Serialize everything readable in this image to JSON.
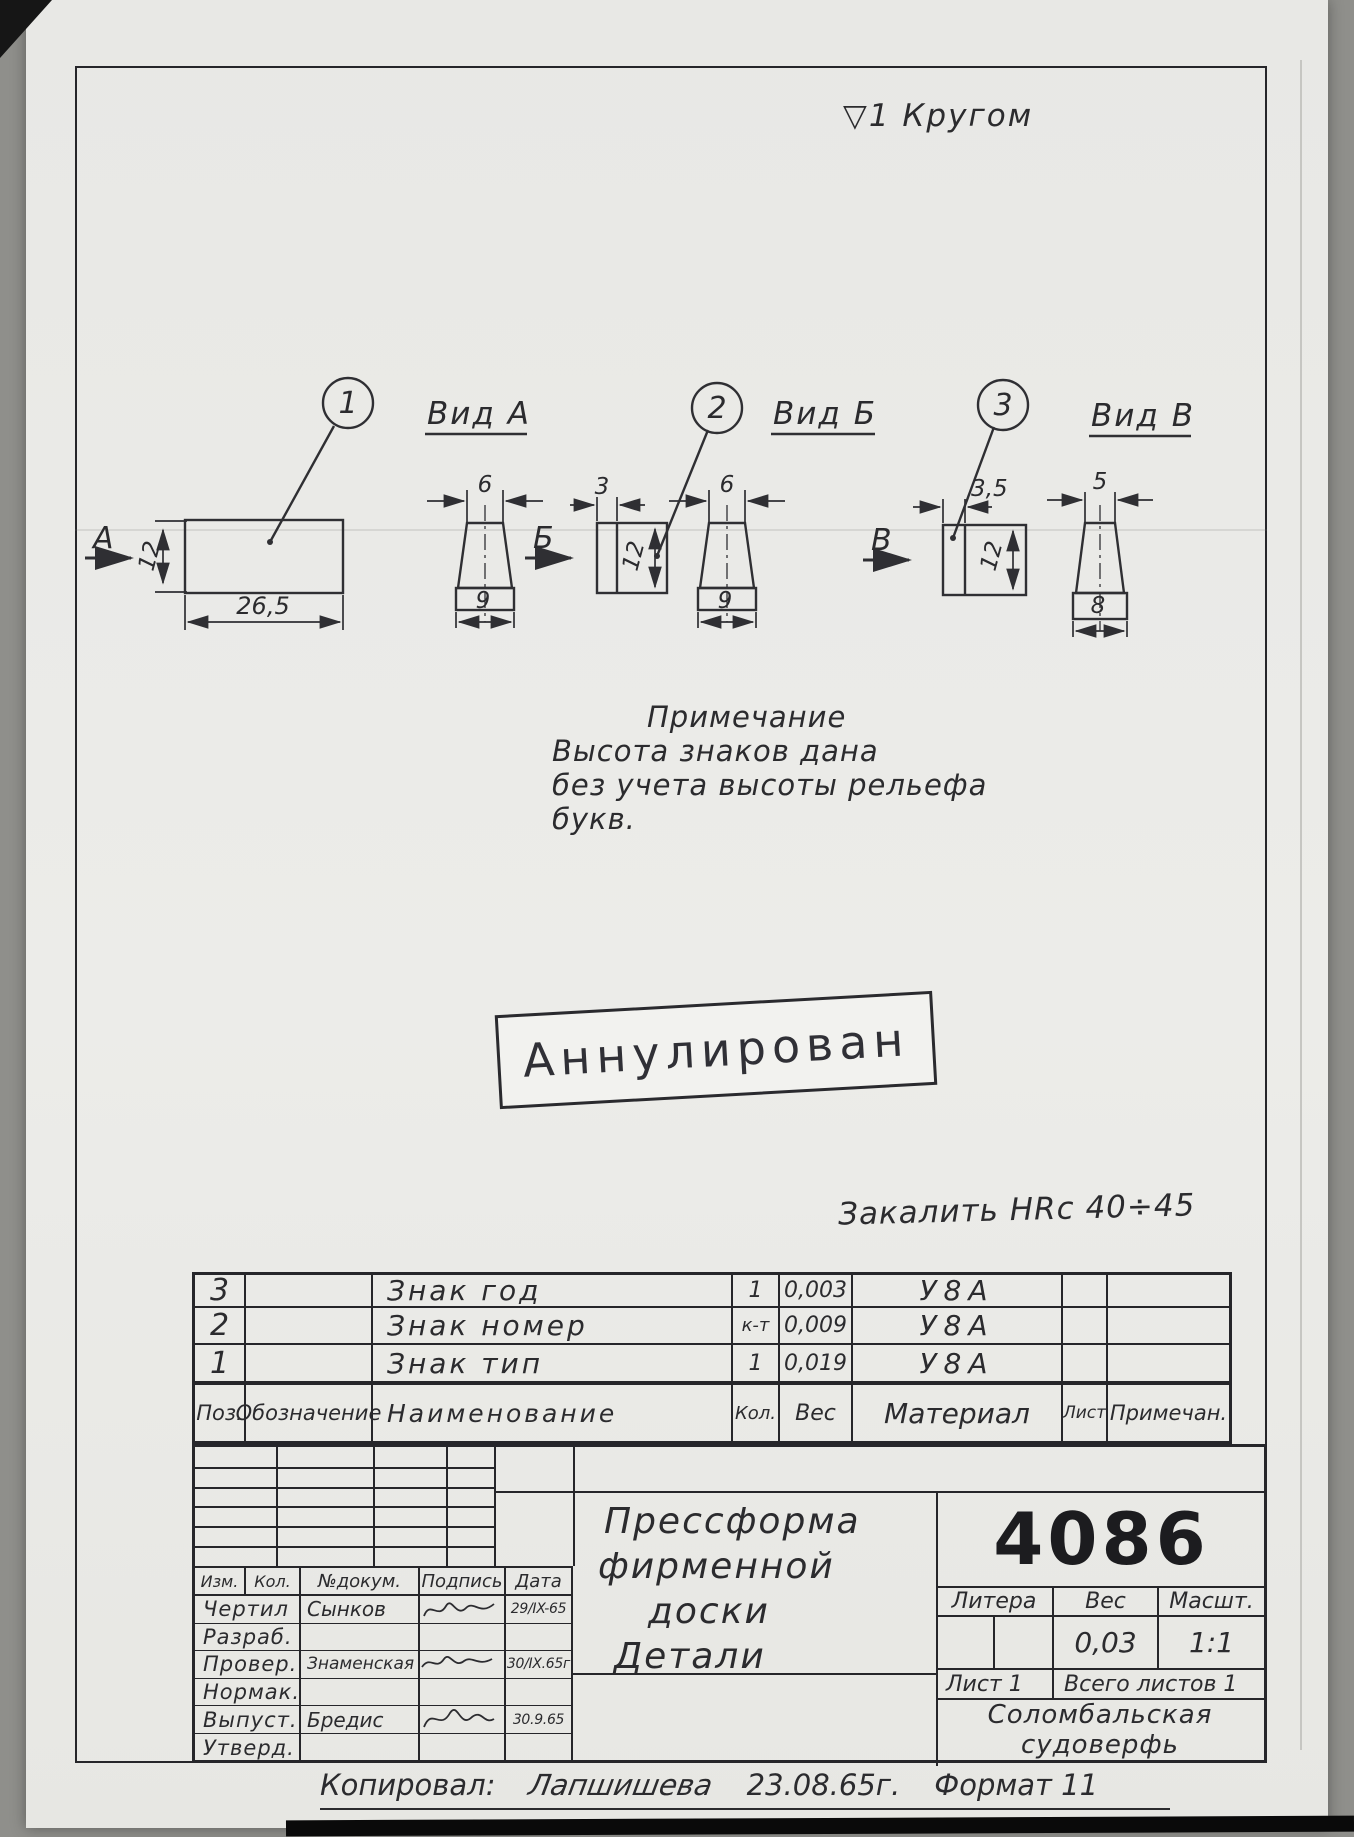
{
  "annotations": {
    "surface_finish": "▽1 Кругом",
    "hardening": "Закалить HRc 40÷45",
    "stamp": "Аннулирован"
  },
  "note": {
    "title": "Примечание",
    "line1": "Высота знаков дана",
    "line2": "без учета высоты рельефа",
    "line3": "букв."
  },
  "views": {
    "callout_1": "1",
    "callout_2": "2",
    "callout_3": "3",
    "label_a": "Вид А",
    "label_b": "Вид Б",
    "label_v": "Вид В",
    "arrow_a": "А",
    "arrow_b": "Б",
    "arrow_v": "В",
    "dim_plate_width": "26,5",
    "dim_plate_height": "12",
    "dim_a_top": "6",
    "dim_a_bottom": "9",
    "dim_b_thickness": "3",
    "dim_b_height": "12",
    "dim_b_top": "6",
    "dim_b_bottom": "9",
    "dim_v_thickness": "3,5",
    "dim_v_height": "12",
    "dim_v_top": "5",
    "dim_v_bottom": "8"
  },
  "parts_table": {
    "headers": {
      "pos": "Поз.",
      "designation": "Обозначение",
      "name": "Наименование",
      "qty": "Кол.",
      "weight": "Вес",
      "material": "Материал",
      "sheet": "Лист",
      "note": "Примечан."
    },
    "rows": [
      {
        "pos": "3",
        "name": "Знак год",
        "qty": "1",
        "weight": "0,003",
        "material": "У8А"
      },
      {
        "pos": "2",
        "name": "Знак номер",
        "qty": "к-т",
        "weight": "0,009",
        "material": "У8А"
      },
      {
        "pos": "1",
        "name": "Знак тип",
        "qty": "1",
        "weight": "0,019",
        "material": "У8А"
      }
    ]
  },
  "title_block": {
    "doc_number": "4086",
    "title_lines": [
      "Прессформа",
      "фирменной",
      "доски",
      "Детали"
    ],
    "litera_label": "Литера",
    "weight_label": "Вес",
    "scale_label": "Масшт.",
    "weight_value": "0,03",
    "scale_value": "1:1",
    "sheet_info": "Лист 1",
    "total_sheets": "Всего листов 1",
    "org_line1": "Соломбальская",
    "org_line2": "судоверфь",
    "rev_headers": {
      "izm": "Изм.",
      "kol": "Кол.",
      "doc": "№докум.",
      "sign": "Подпись",
      "date": "Дата"
    },
    "staff": [
      {
        "role": "Чертил",
        "name": "Сынков",
        "date": "29/IX-65"
      },
      {
        "role": "Разраб.",
        "name": "",
        "date": ""
      },
      {
        "role": "Провер.",
        "name": "Знаменская",
        "date": "30/IX.65г"
      },
      {
        "role": "Нормак.",
        "name": "",
        "date": ""
      },
      {
        "role": "Выпуст.",
        "name": "Бредис",
        "date": "30.9.65"
      },
      {
        "role": "Утверд.",
        "name": "",
        "date": ""
      }
    ]
  },
  "footer": {
    "copied_label": "Копировал:",
    "copied_by": "Лапшишева",
    "date": "23.08.65г.",
    "format": "Формат 11"
  }
}
